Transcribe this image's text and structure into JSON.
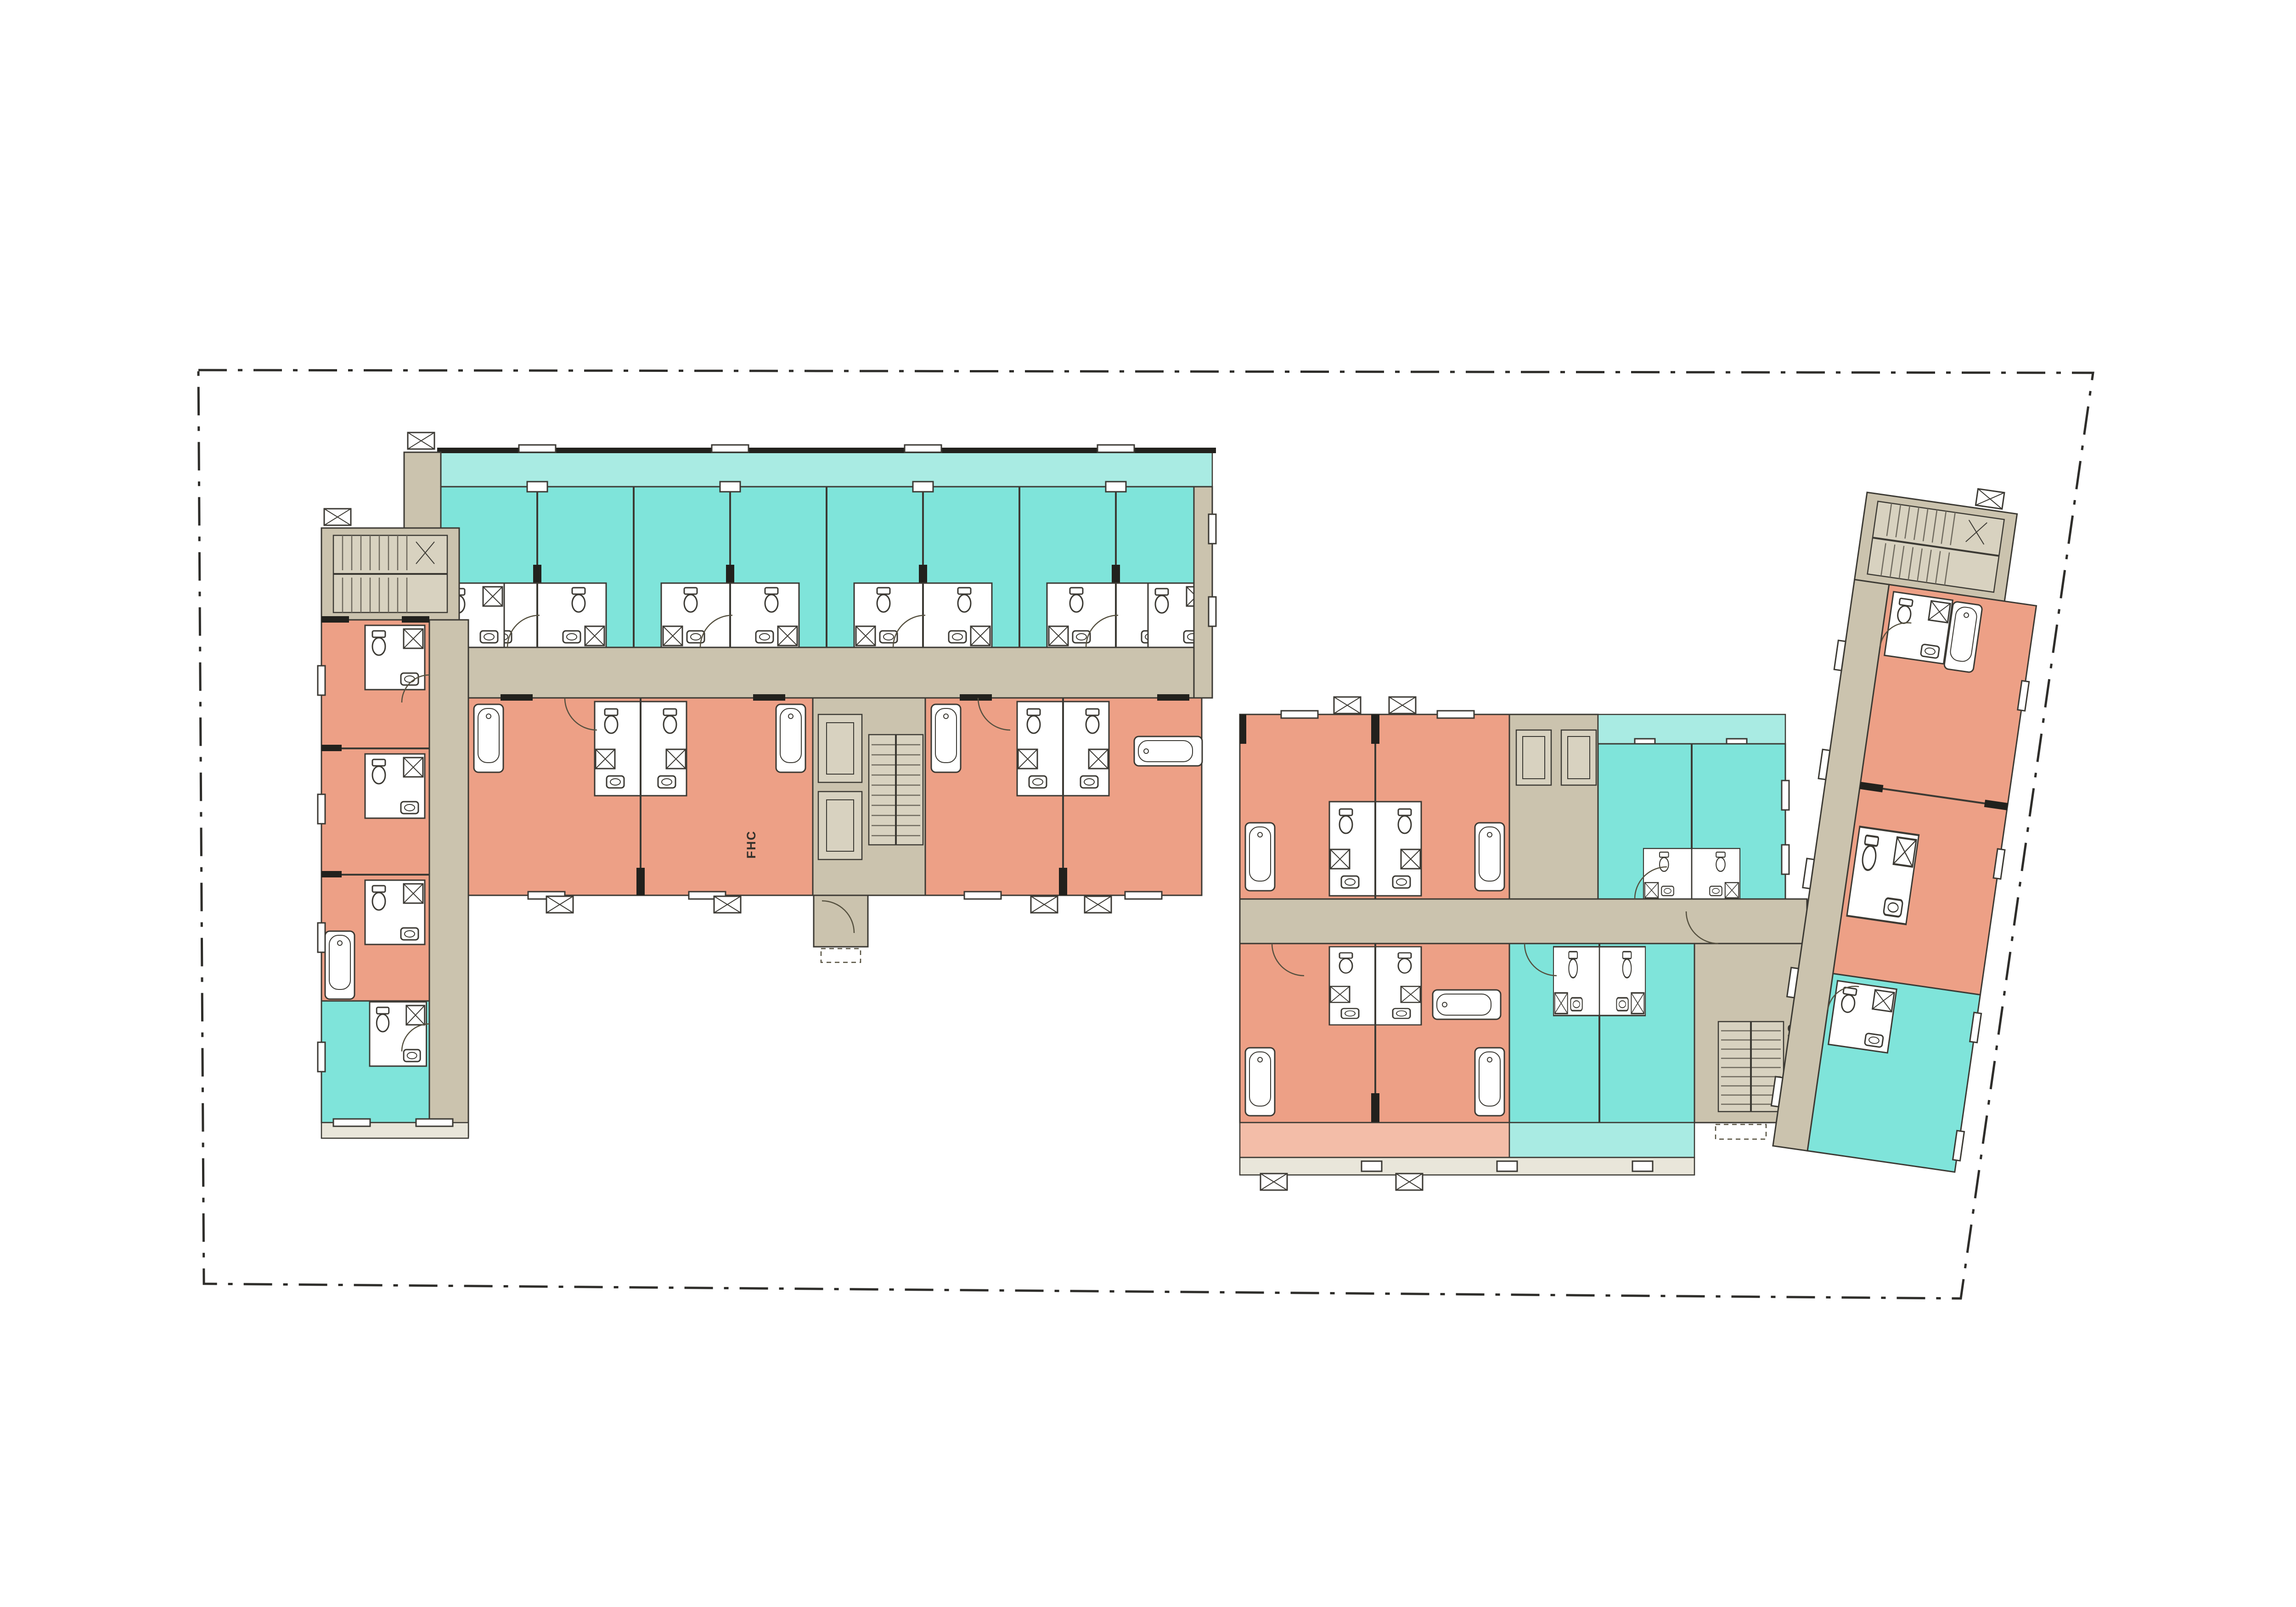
{
  "site": {
    "boundary_points": "432,806 4558,812 4270,2828 444,2796",
    "boundary_line_style": "dash-dot property line"
  },
  "palette": {
    "background": "#ffffff",
    "cyan": "#7fe4da",
    "cyan_light": "#a9ebe3",
    "salmon": "#eda086",
    "salmon_light": "#f3bda8",
    "tan": "#cbc3ae",
    "tan_light": "#d8d2c0",
    "deck": "#e9e6da",
    "wall": "#22211d",
    "line": "#3c3a34",
    "white": "#ffffff"
  },
  "labels": {
    "fire_hose_cabinet_west": "FHC",
    "fire_hose_cabinet_east": "FHC"
  },
  "stats": {
    "buildings": 2,
    "west_building": {
      "cyan_units": 9,
      "salmon_units": 7,
      "stairs": 2,
      "elevators": 2
    },
    "east_building": {
      "cyan_units": 5,
      "salmon_units": 6,
      "stairs": 2,
      "elevators": 2
    }
  }
}
